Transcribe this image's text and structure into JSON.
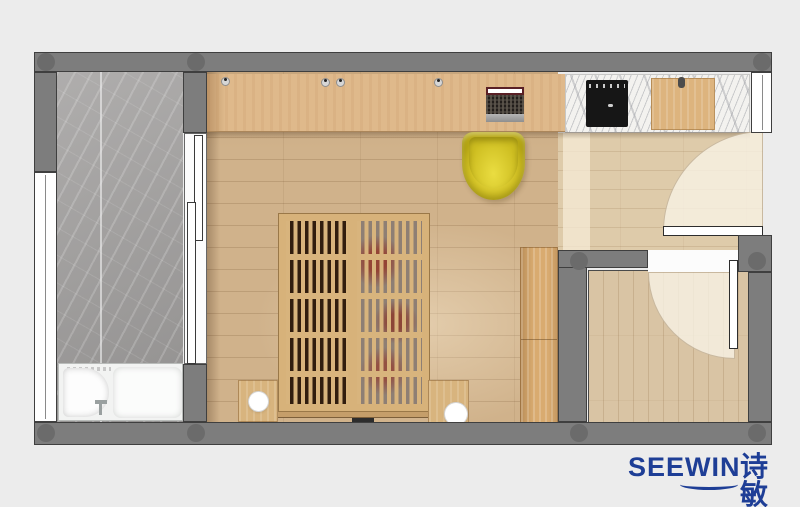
{
  "brand": {
    "name_en": "SEEWIN",
    "name_cn": "诗敏",
    "logo_color": "#1e3e96"
  },
  "plan": {
    "type": "apartment-floor-plan-top-view",
    "rooms": [
      {
        "name": "bathroom",
        "position": "left",
        "floor_material": "gray marble slab"
      },
      {
        "name": "main-bedroom-studio",
        "position": "center",
        "floor_material": "oak plank"
      },
      {
        "name": "kitchenette",
        "position": "top-right",
        "floor_material": "white marble countertop"
      },
      {
        "name": "entry-hall",
        "position": "right",
        "floor_material": "light oak plank"
      },
      {
        "name": "secondary-room",
        "position": "bottom-right",
        "floor_material": "light oak plank"
      }
    ],
    "furniture": [
      {
        "name": "bathtub-with-seat",
        "room": "bathroom",
        "color": "#f2f3f2"
      },
      {
        "name": "sliding-door",
        "room": "bathroom"
      },
      {
        "name": "desk-counter",
        "room": "main-bedroom-studio",
        "color": "#dfb98b"
      },
      {
        "name": "laptop",
        "room": "main-bedroom-studio"
      },
      {
        "name": "desk-grommets",
        "room": "main-bedroom-studio",
        "count": 4
      },
      {
        "name": "yellow-shell-chair",
        "room": "main-bedroom-studio",
        "color": "#d6c527"
      },
      {
        "name": "slatted-platform-bed",
        "room": "main-bedroom-studio",
        "color": "#d8b47d"
      },
      {
        "name": "nightstand-with-round-lamp",
        "room": "main-bedroom-studio",
        "count": 2
      },
      {
        "name": "wardrobe-cabinet",
        "room": "main-bedroom-studio",
        "color": "#d9ab70"
      },
      {
        "name": "induction-cooktop",
        "room": "kitchenette",
        "color": "#161616"
      },
      {
        "name": "cutting-board",
        "room": "kitchenette",
        "color": "#ddb47e"
      },
      {
        "name": "entry-door-with-swing-arc",
        "room": "entry-hall"
      },
      {
        "name": "interior-door-with-swing-arc",
        "room": "secondary-room"
      }
    ],
    "structure": {
      "wall_color": "#7d7d7d",
      "column_dot_color": "#6b6b6b",
      "background_color": "#ececec",
      "windows": [
        "left-exterior-window",
        "top-right-exterior-window"
      ]
    }
  }
}
